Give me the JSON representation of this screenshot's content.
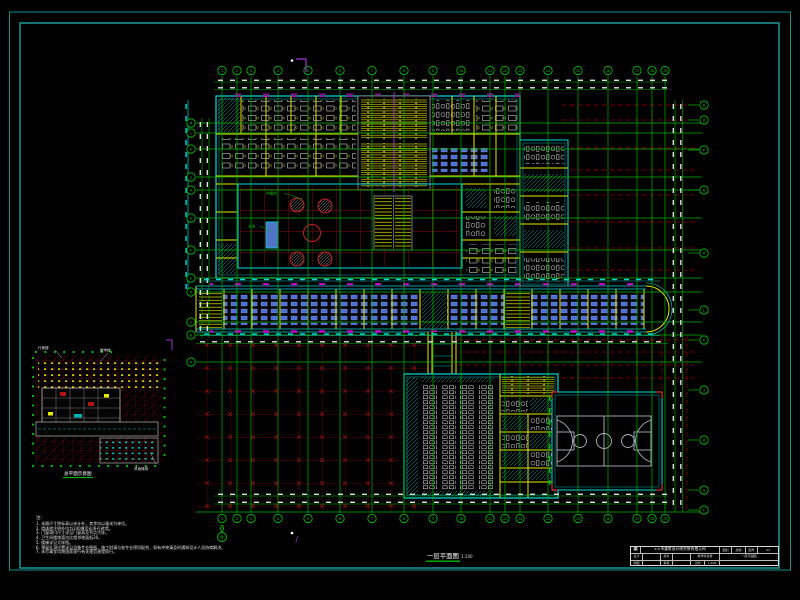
{
  "sheet": {
    "background": "#000000",
    "frame_color": "#1d8e8e"
  },
  "colors": {
    "grid_green": "#00b400",
    "bubble_green": "#00c800",
    "wall_yellow": "#e8e800",
    "dim_cyan": "#00dcdc",
    "red_dark": "#7a0000",
    "red_bright": "#c82020",
    "desk_blue": "#4b6fd4",
    "magenta": "#d400d4",
    "purple": "#a432d2",
    "white": "#e0e0e0",
    "court_gray": "#aeb6c2"
  },
  "captions": {
    "main_title": "一层平面图",
    "main_scale": "1:100",
    "key_plan_title": "总平面示意图"
  },
  "grid": {
    "vertical_axes": {
      "labels": [
        "1",
        "2",
        "3",
        "4",
        "5",
        "6",
        "7",
        "8",
        "9",
        "10",
        "11",
        "12",
        "13",
        "14",
        "15",
        "16",
        "17",
        "18",
        "19"
      ],
      "x": [
        222,
        237,
        251,
        278,
        308,
        340,
        372,
        404,
        433,
        461,
        490,
        505,
        520,
        548,
        578,
        608,
        637,
        652,
        665
      ]
    },
    "horizontal_axes_left": {
      "labels": [
        "M",
        "L",
        "K",
        "J",
        "H",
        "G",
        "F",
        "E",
        "D",
        "C",
        "B",
        "A"
      ],
      "y": [
        123,
        133,
        149,
        177,
        190,
        218,
        250,
        278,
        292,
        322,
        335,
        362
      ]
    },
    "horizontal_axes_right": {
      "labels": [
        "R",
        "Q",
        "P",
        "N",
        "M",
        "L",
        "K",
        "J",
        "H",
        "G",
        "F"
      ],
      "y": [
        105,
        120,
        150,
        190,
        253,
        310,
        340,
        390,
        440,
        490,
        510
      ]
    }
  },
  "key_plan": {
    "labels": [
      "行政楼",
      "教学楼",
      "风雨操场"
    ]
  },
  "annotations": {
    "planter": "种植池",
    "pool": "水池"
  },
  "markers": {
    "section_bottom": "J"
  },
  "notes": {
    "title": "注:",
    "lines": [
      "1. 本图尺寸除标高以米计外，其余均以毫米为单位。",
      "2. 墙体除注明外均为240厚页岩多孔砖墙。",
      "3. 门窗洞口尺寸详见门窗表及节点大样。",
      "4. 卫生间楼地面均比相邻地面低20。",
      "5. 楼梯详见大样图。",
      "6. 预留孔洞位置详见设备专业图纸，施工时请与各专业密切配合，如有冲突请及时通知设计人员协商解决。",
      "7. 未尽事宜均按国家现行有关规范规程执行。"
    ]
  },
  "title_block": {
    "company": "××市建筑设计研究院有限公司",
    "class_label": "图别",
    "class_val": "建施",
    "no_label": "图号",
    "no_val": "03",
    "design_label": "设计",
    "check_label": "校对",
    "draw_label": "制图",
    "audit_label": "审核",
    "scale_label": "比例",
    "scale_val": "1:100",
    "project": "教学综合楼",
    "drawing": "一层平面图"
  }
}
